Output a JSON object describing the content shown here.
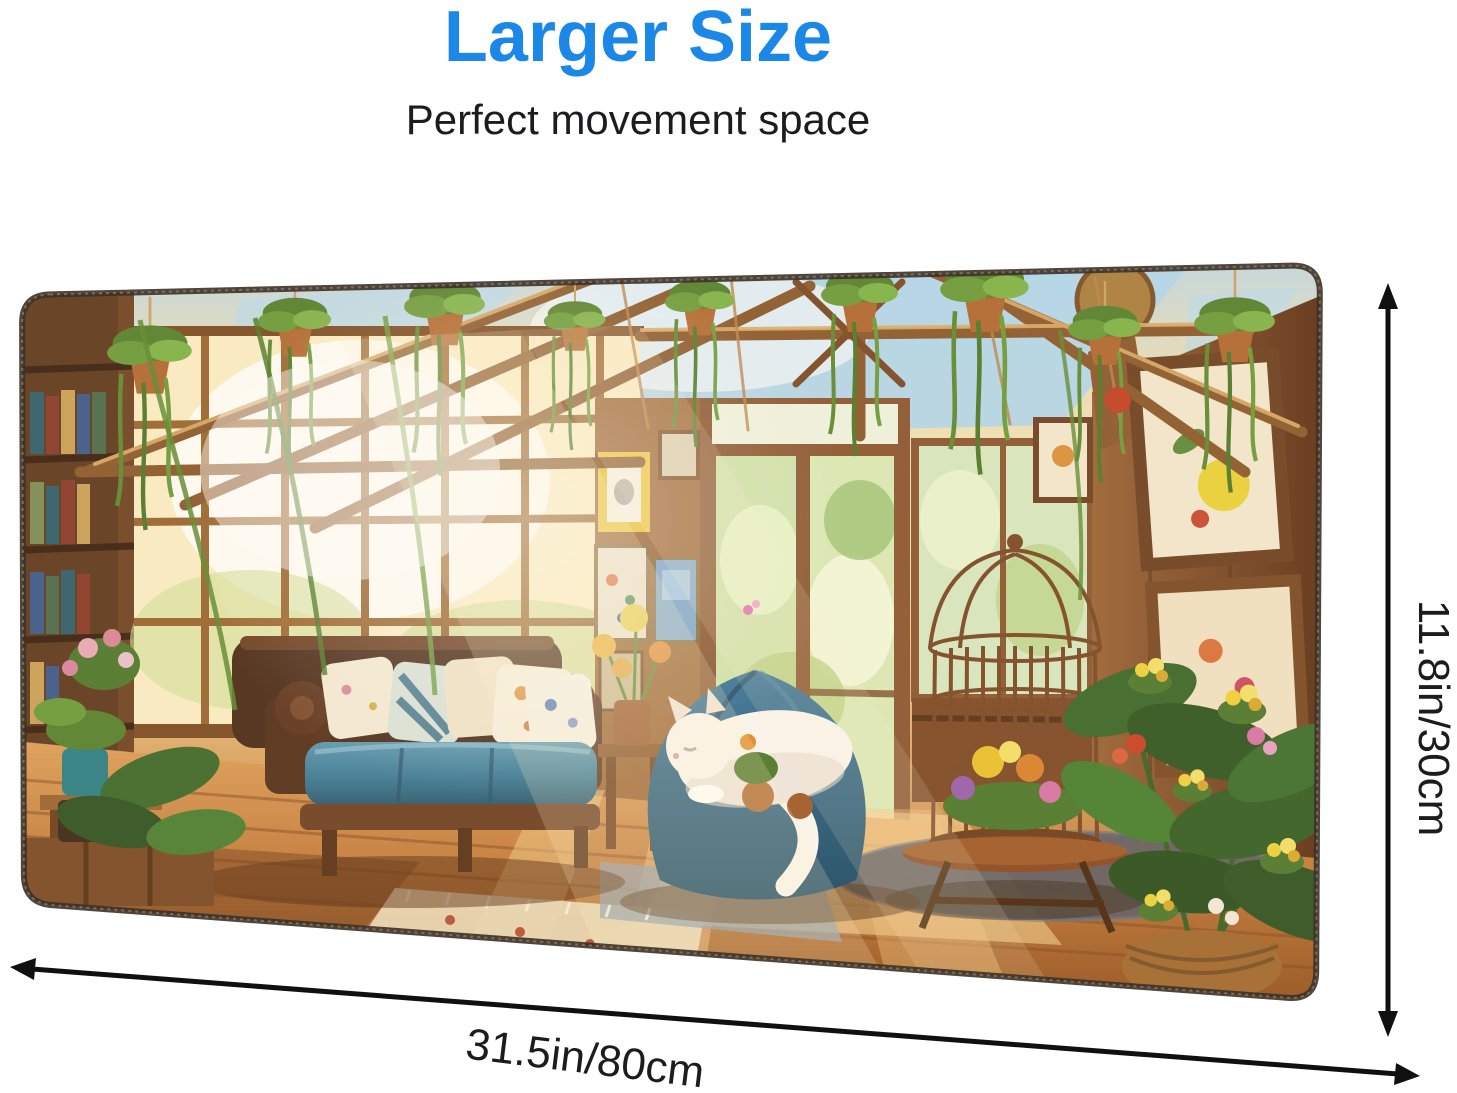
{
  "header": {
    "title": "Larger Size",
    "subtitle": "Perfect movement space"
  },
  "dimensions": {
    "height_label": "11.8in/30cm",
    "width_label": "31.5in/80cm"
  },
  "colors": {
    "accent": "#1b87e6",
    "text": "#1c1c1e",
    "arrow": "#101010",
    "background": "#ffffff",
    "pad_edge": "#3c3128",
    "floor_wood": "#c07a3c",
    "plant_green": "#4e7a2c",
    "couch_brown": "#4a2c1a",
    "cushion_teal": "#3f7f9b",
    "beanbag_blue": "#2e6a8c",
    "cat_white": "#faf7f2",
    "terracotta_pot": "#b06a33",
    "sky_blue": "#aed6ef"
  }
}
